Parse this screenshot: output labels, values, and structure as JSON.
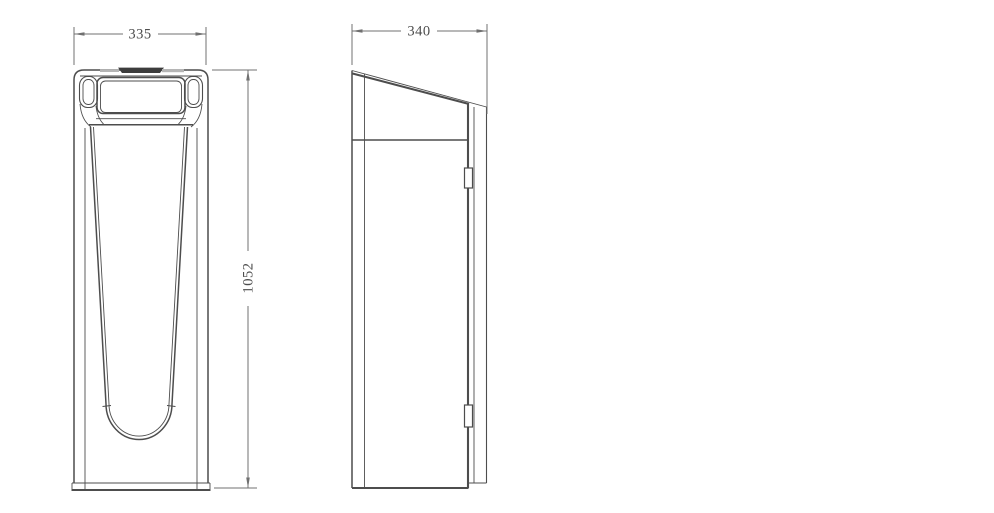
{
  "drawing": {
    "type": "orthographic-technical-drawing",
    "views": {
      "front": {
        "name": "front view",
        "width_dim": "335",
        "height_dim": "1052"
      },
      "side": {
        "name": "side view",
        "depth_dim": "340"
      }
    },
    "dimensions": {
      "front_width": {
        "value": "335"
      },
      "overall_height": {
        "value": "1052"
      },
      "side_depth": {
        "value": "340"
      }
    }
  },
  "colors": {
    "background": "#ffffff",
    "object_line": "#4d4d4d",
    "dimension_line": "#707070",
    "text": "#4d4d4d",
    "top_bar": "#3c3c3c",
    "top_bar_light": "#b5b5b5"
  }
}
